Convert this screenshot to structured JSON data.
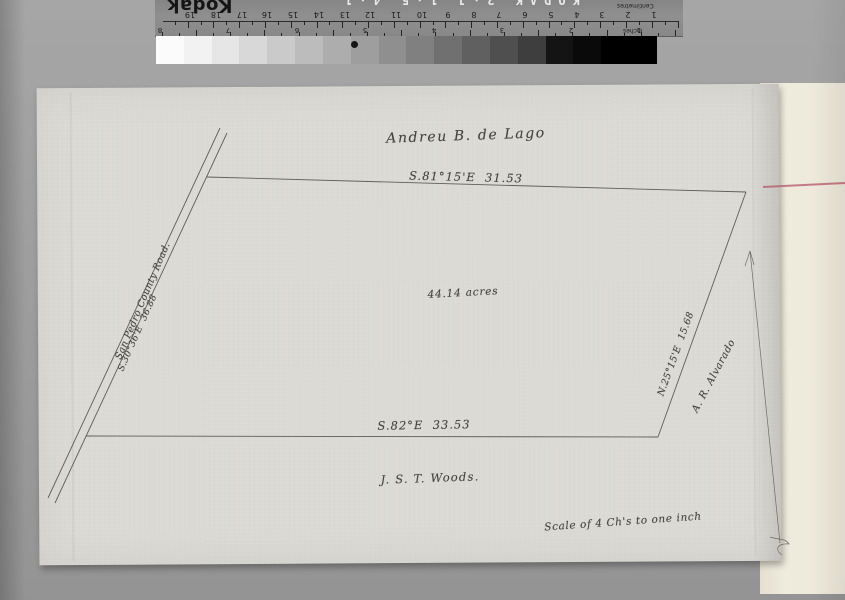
{
  "ruler": {
    "brand": "Kodak",
    "film_edge_text": "KODAK 2·J 1·5 4·1",
    "centimetres_label": "Centimetres",
    "inches_label": "Inches",
    "cm_numbers": [
      1,
      2,
      3,
      4,
      5,
      6,
      7,
      8,
      9,
      10,
      11,
      12,
      13,
      14,
      15,
      16,
      17,
      18,
      19
    ],
    "inch_numbers": [
      1,
      2,
      3,
      4,
      5,
      6,
      7,
      8
    ]
  },
  "gray_wedge": {
    "steps": [
      "#fbfbfb",
      "#f2f2f2",
      "#e6e6e6",
      "#d8d8d8",
      "#cacaca",
      "#bcbcbc",
      "#adadad",
      "#9e9e9e",
      "#8f8f8f",
      "#808080",
      "#707070",
      "#606060",
      "#4f4f4f",
      "#3e3e3e",
      "#141414",
      "#0a0a0a",
      "#000000",
      "#000000"
    ],
    "dot_color": "#161616"
  },
  "plat": {
    "owner_title": "Andreu B. de Lago",
    "north_line_bearing": "S.81°15'E  31.53",
    "south_line_bearing": "S.82°E  33.53",
    "east_line_bearing": "N.25°15'E  15.68",
    "east_neighbor": "A. R. Alvarado",
    "road_name": "San Pedro County Road.",
    "road_bearing": "S.30°36'E  36.88",
    "area_label": "44.14 acres",
    "surveyor": "J. S. T. Woods.",
    "scale_note": "Scale of 4 Ch's to one inch"
  },
  "colors": {
    "background": "#9c9c9c",
    "paper": "#dbdad5",
    "backing_sheet": "#ece8da",
    "ink": "#45443f",
    "red_line": "#b5576b",
    "ruler_face": "#8b8b8b"
  }
}
